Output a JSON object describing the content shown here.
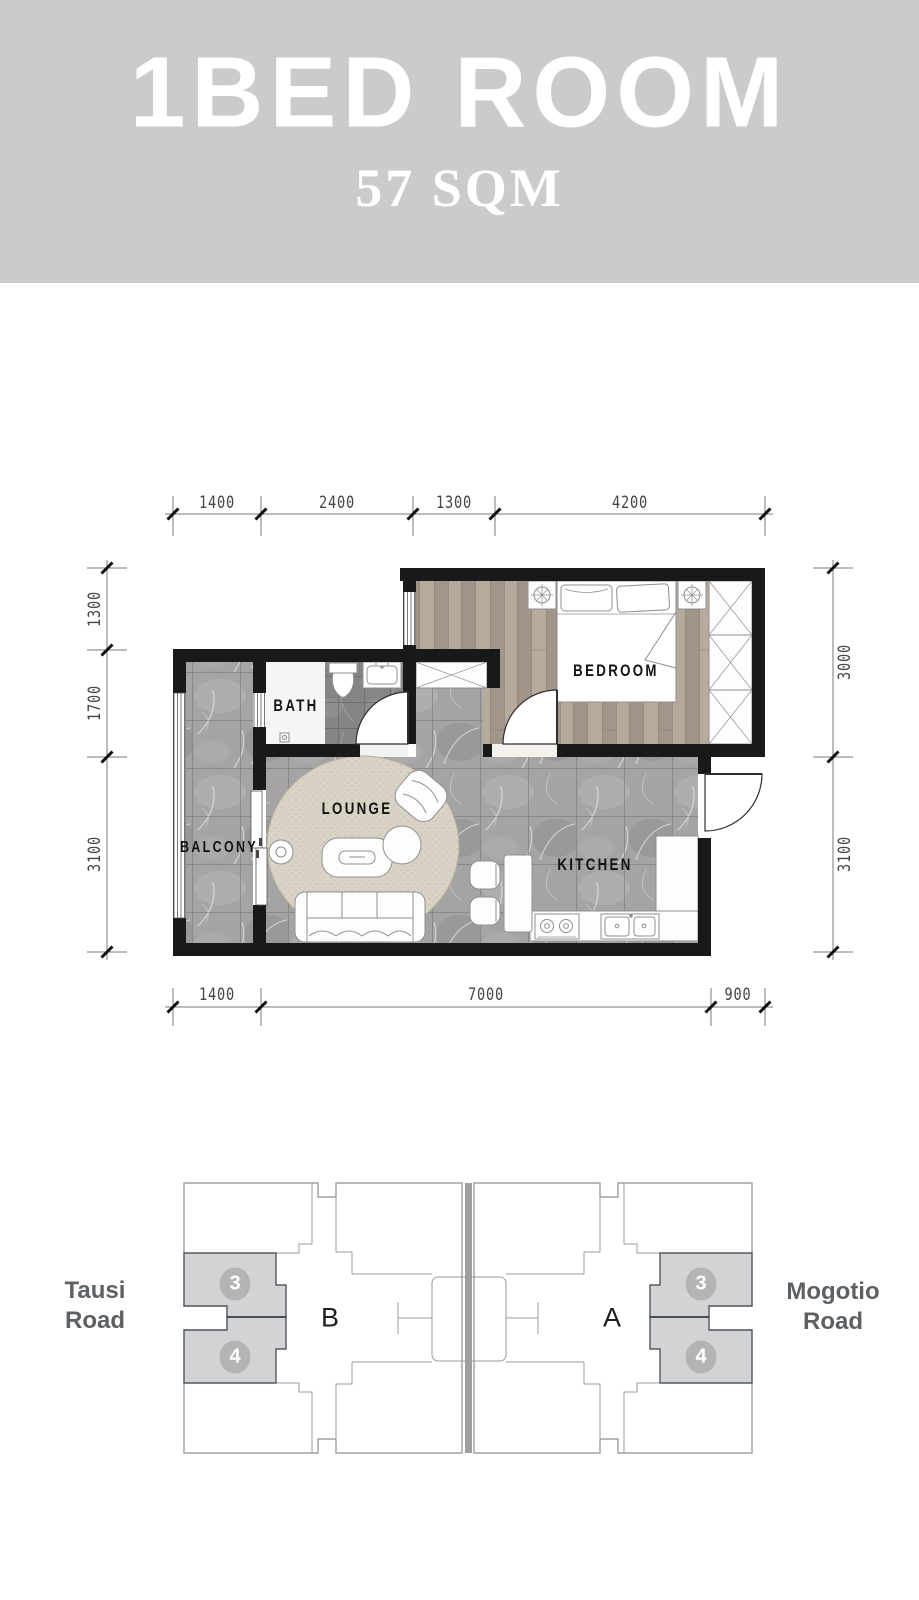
{
  "banner": {
    "title": "1BED ROOM",
    "subtitle": "57 SQM",
    "bg_color": "#cbcbcb",
    "text_color": "#ffffff"
  },
  "floor_plan": {
    "room_labels": {
      "bedroom": "BEDROOM",
      "bath": "BATH",
      "lounge": "LOUNGE",
      "balcony": "BALCONY",
      "kitchen": "KITCHEN"
    },
    "dimensions": {
      "top": [
        "1400",
        "2400",
        "1300",
        "4200"
      ],
      "bottom": [
        "1400",
        "7000",
        "900"
      ],
      "left": [
        "1300",
        "1700",
        "3100"
      ],
      "right": [
        "3000",
        "3100"
      ]
    }
  },
  "site_plan": {
    "road_left": "Tausi Road",
    "road_right": "Mogotio Road",
    "block_left_label": "B",
    "block_right_label": "A",
    "unit_badges_left": [
      "3",
      "4"
    ],
    "unit_badges_right": [
      "3",
      "4"
    ],
    "highlight_color": "#d2d3d5",
    "road_text_color": "#5d6164",
    "divider_color": "#9f9f9f"
  }
}
